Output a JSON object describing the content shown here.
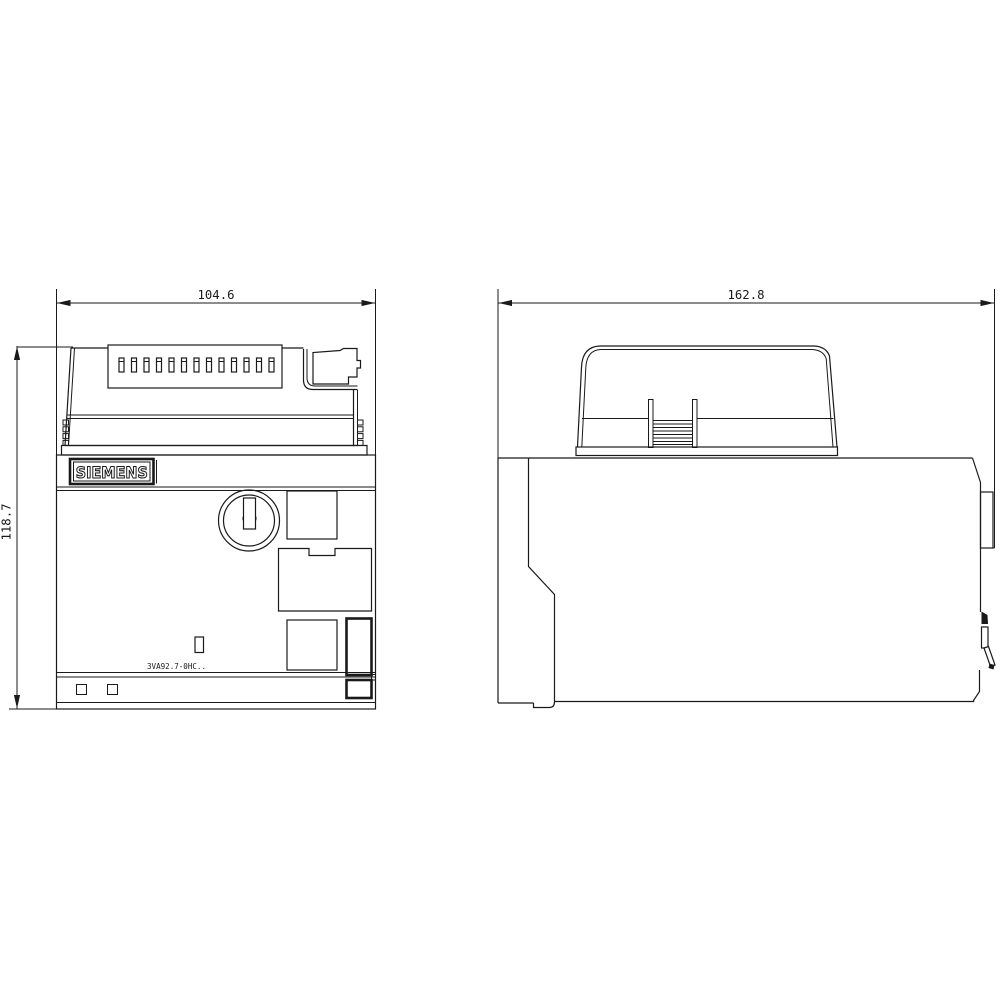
{
  "brand": {
    "label": "SIEMENS"
  },
  "product": {
    "model_code": "3VA92.7-0HC.."
  },
  "dimensions": {
    "front_width": "104.6",
    "front_height": "118.7",
    "side_width": "162.8"
  },
  "colors": {
    "line": "#1a1a1a",
    "background": "#ffffff"
  }
}
